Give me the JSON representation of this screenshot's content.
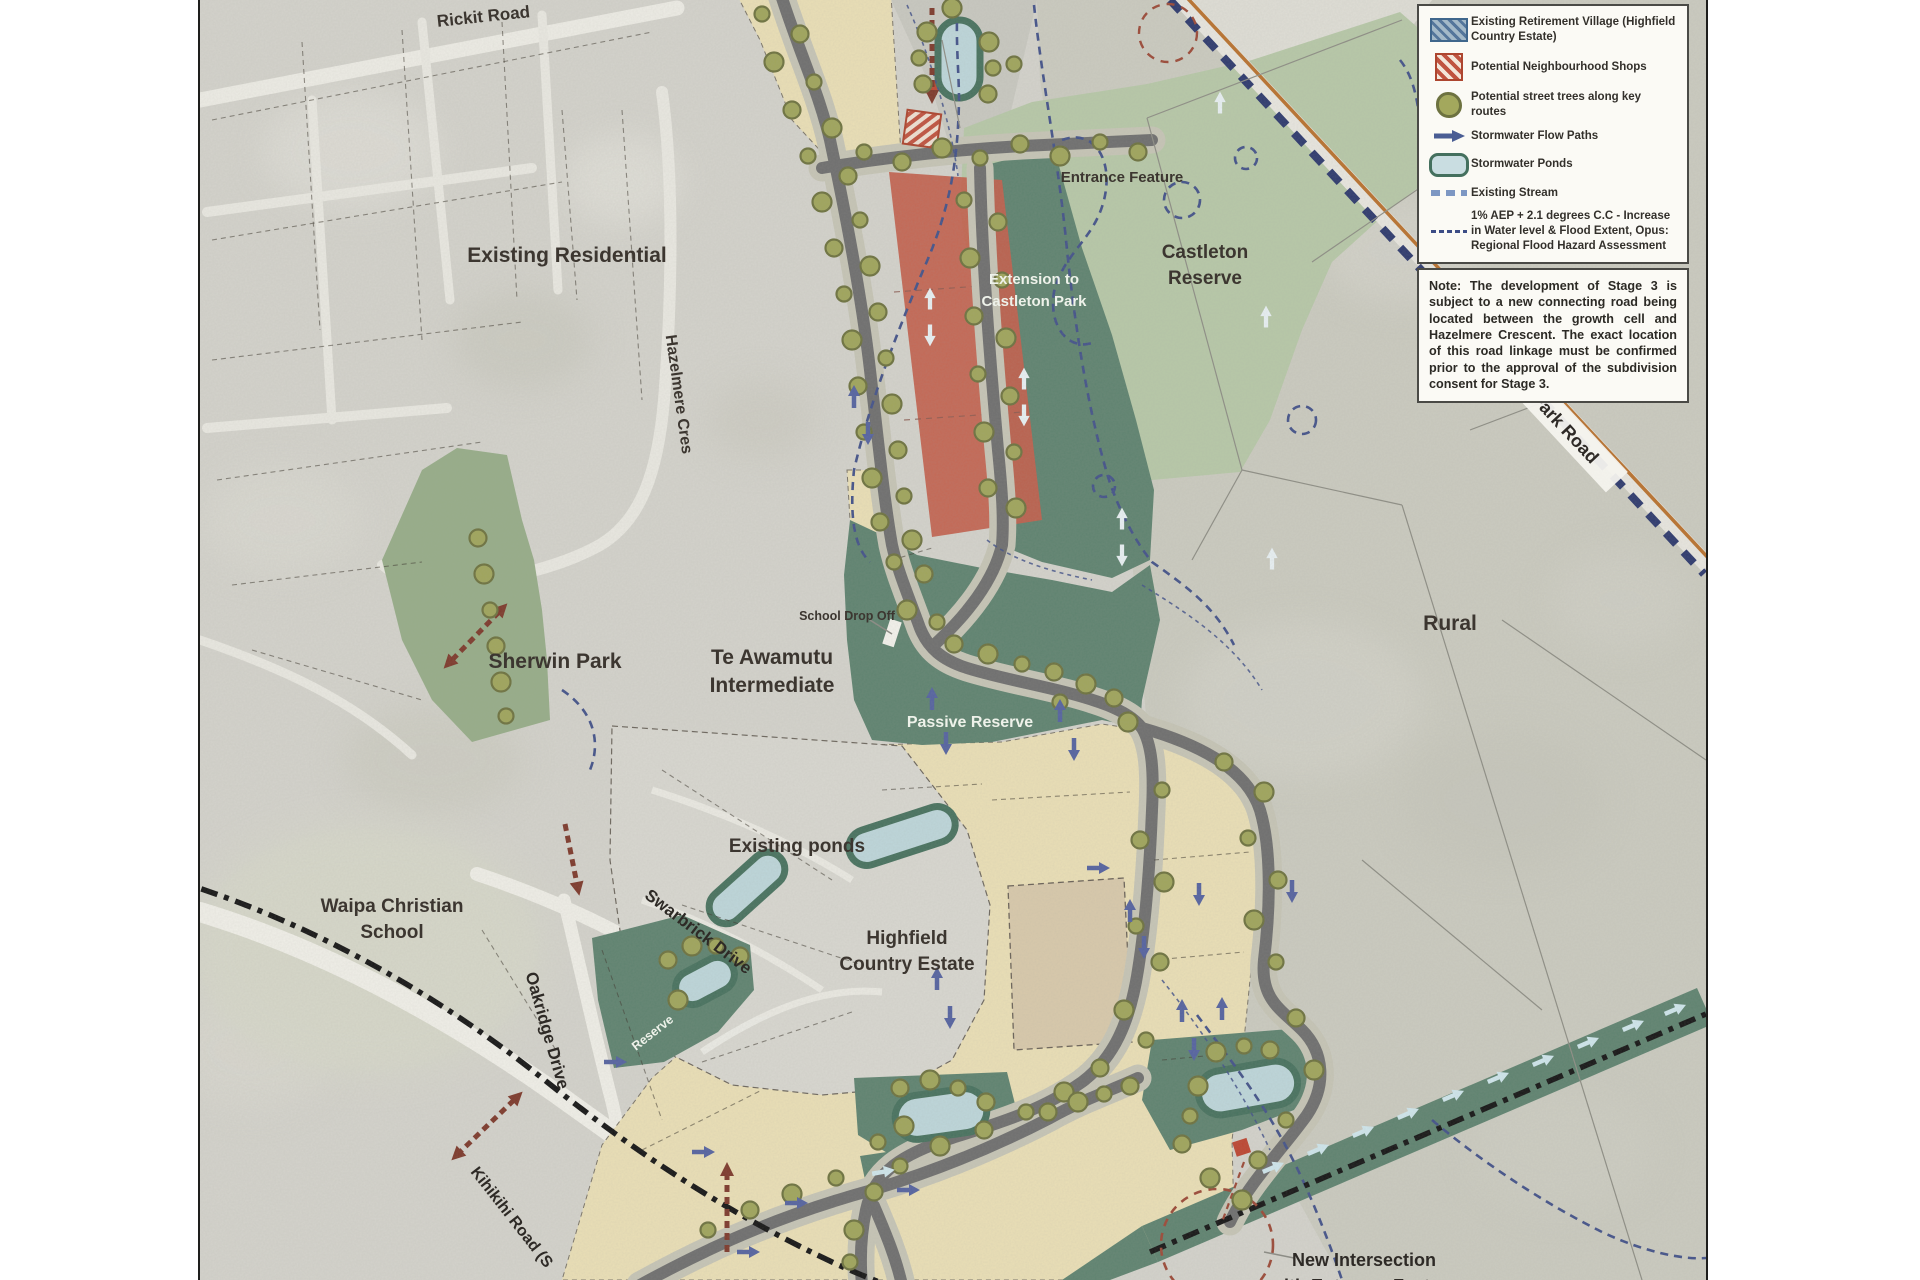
{
  "map_labels": {
    "rickit_road": "Rickit Road",
    "existing_residential": "Existing Residential",
    "hazelmere_cres": "Hazelmere Cres",
    "entrance_feature": "Entrance Feature",
    "castleton_reserve_line1": "Castleton",
    "castleton_reserve_line2": "Reserve",
    "extension_line1": "Extension to",
    "extension_line2": "Castleton Park",
    "park_road": "Park Road",
    "rural": "Rural",
    "school_drop_off": "School Drop Off",
    "te_awamutu_line1": "Te Awamutu",
    "te_awamutu_line2": "Intermediate",
    "sherwin_park": "Sherwin Park",
    "passive_reserve": "Passive Reserve",
    "existing_ponds": "Existing ponds",
    "highfield_line1": "Highfield",
    "highfield_line2": "Country Estate",
    "waipa_line1": "Waipa Christian",
    "waipa_line2": "School",
    "swarbrick_drive": "Swarbrick Drive",
    "oakridge_drive": "Oakridge Drive",
    "reserve": "Reserve",
    "kihikihi_road": "Kihikihi Road (S",
    "new_intersection_line1": "New Intersection",
    "new_intersection_line2": "with Entrance Feature"
  },
  "legend": {
    "items": [
      {
        "icon": "retirement-village-hatch-swatch",
        "label": "Existing Retirement Village (Highfield Country Estate)"
      },
      {
        "icon": "neighbourhood-shops-hatch-swatch",
        "label": "Potential Neighbourhood Shops"
      },
      {
        "icon": "street-tree-icon",
        "label": "Potential street trees along key routes"
      },
      {
        "icon": "stormwater-flow-arrow-icon",
        "label": "Stormwater Flow Paths"
      },
      {
        "icon": "stormwater-pond-swatch",
        "label": "Stormwater Ponds"
      },
      {
        "icon": "existing-stream-dash-swatch",
        "label": "Existing Stream"
      },
      {
        "icon": "flood-extent-dash-swatch",
        "label": "1% AEP + 2.1 degrees C.C - Increase in Water level & Flood Extent, Opus: Regional Flood Hazard Assessment"
      }
    ]
  },
  "note": {
    "text": "Note: The development of Stage 3 is subject to a new connecting road being located between the growth cell and Hazelmere Crescent. The exact location of this road linkage must be confirmed prior to the approval of the subdivision consent for Stage 3."
  },
  "colors": {
    "development_area_cream": "#eadfb6",
    "superlot_tan": "#d8c9ab",
    "neighbourhood_shops_red": "#c2604c",
    "reserve_dark_green": "#5f8370",
    "reserve_light_green": "#b7c8a8",
    "sherwin_green": "#97ad89",
    "pond_blue": "#bdd6da",
    "road_grey": "#6f6f6f",
    "road_verge": "#c6c5b6",
    "tree_olive": "#a0a55c",
    "stream_navy": "#44538a",
    "flow_arrow_navy": "#5563a0",
    "flow_arrow_white": "#e8f0f3",
    "railway_orange": "#b9722f",
    "connection_red": "#8a3b2e",
    "aerial_grey": "#d3d2cb"
  }
}
